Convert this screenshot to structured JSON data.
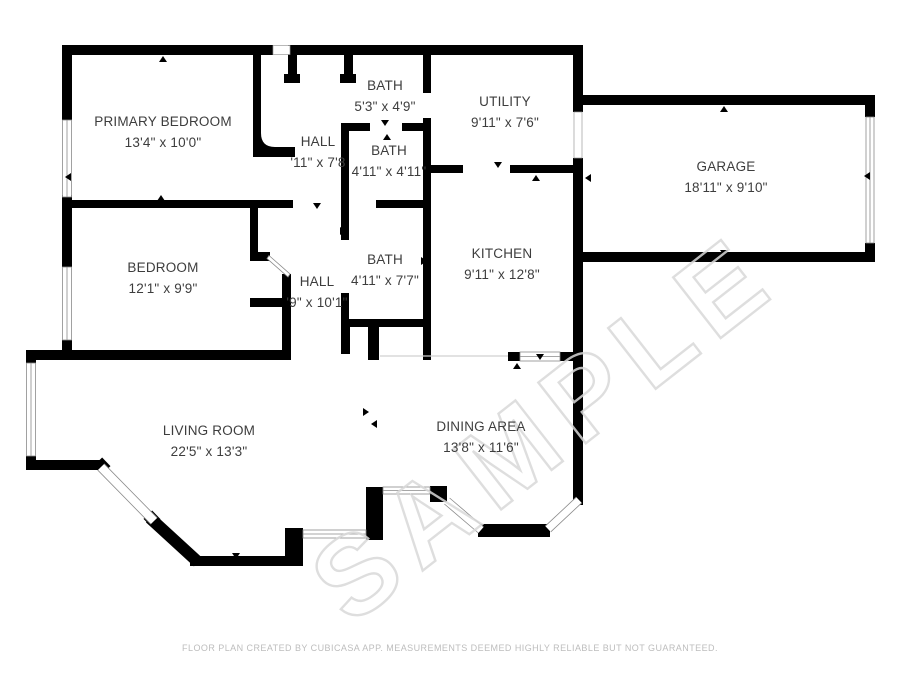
{
  "plan": {
    "rooms": [
      {
        "id": "primary-bedroom",
        "name": "PRIMARY BEDROOM",
        "dims": "13'4\" x 10'0\""
      },
      {
        "id": "hall-upper",
        "name": "HALL",
        "dims": "'11\" x 7'8"
      },
      {
        "id": "bath-top",
        "name": "BATH",
        "dims": "5'3\" x 4'9\""
      },
      {
        "id": "utility",
        "name": "UTILITY",
        "dims": "9'11\" x 7'6\""
      },
      {
        "id": "bath-middle",
        "name": "BATH",
        "dims": "4'11\" x 4'11\""
      },
      {
        "id": "garage",
        "name": "GARAGE",
        "dims": "18'11\" x 9'10\""
      },
      {
        "id": "bedroom",
        "name": "BEDROOM",
        "dims": "12'1\" x 9'9\""
      },
      {
        "id": "hall-lower",
        "name": "HALL",
        "dims": "'9\" x 10'1\""
      },
      {
        "id": "bath-lower",
        "name": "BATH",
        "dims": "4'11\" x 7'7\""
      },
      {
        "id": "kitchen",
        "name": "KITCHEN",
        "dims": "9'11\" x 12'8\""
      },
      {
        "id": "living-room",
        "name": "LIVING ROOM",
        "dims": "22'5\" x 13'3\""
      },
      {
        "id": "dining-area",
        "name": "DINING AREA",
        "dims": "13'8\" x 11'6\""
      }
    ],
    "watermark": "SAMPLE",
    "footer": "FLOOR PLAN CREATED BY CUBICASA APP. MEASUREMENTS DEEMED HIGHLY RELIABLE BUT NOT GUARANTEED.",
    "colors": {
      "wall": "#000000",
      "label": "#3d3d3d",
      "footer": "#bdbdbd",
      "watermark": "#d9d9d9"
    }
  }
}
